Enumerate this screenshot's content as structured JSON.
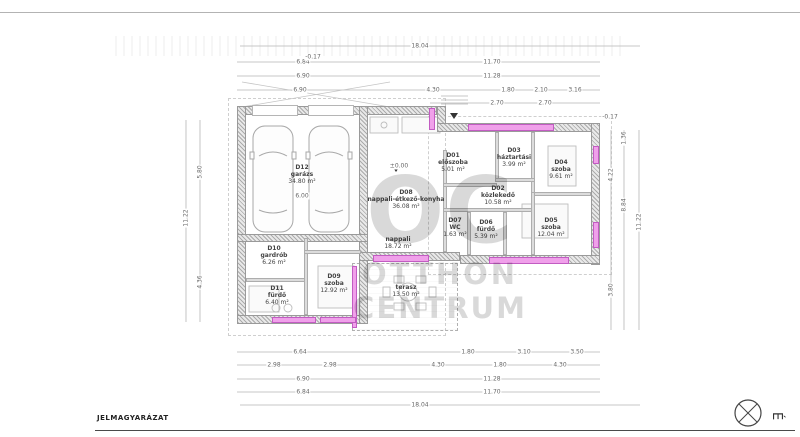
{
  "watermark": {
    "line1": "OC",
    "line2": "OTTHON",
    "line3": "CENTRUM"
  },
  "legend": {
    "label": "JELMAGYARÁZAT"
  },
  "compass": {
    "label": "É"
  },
  "colors": {
    "window_fill": "#f0a0ea",
    "window_border": "#c25cc2",
    "wall_line": "#9a9a9a",
    "drawing_line": "#b5b5b5",
    "text": "#444444",
    "watermark": "rgba(0,0,0,0.15)",
    "legend_text": "#222222"
  },
  "rooms": [
    {
      "id": "D12",
      "name": "garázs",
      "area": "34.80 m²",
      "x": 302,
      "y": 175
    },
    {
      "id": "D01",
      "name": "előszoba",
      "area": "5.01 m²",
      "x": 453,
      "y": 163
    },
    {
      "id": "D02",
      "name": "közlekedő",
      "area": "10.58 m²",
      "x": 498,
      "y": 196
    },
    {
      "id": "D03",
      "name": "háztartási",
      "area": "3.99 m²",
      "x": 514,
      "y": 158
    },
    {
      "id": "D04",
      "name": "szoba",
      "area": "9.61 m²",
      "x": 561,
      "y": 170
    },
    {
      "id": "D05",
      "name": "szoba",
      "area": "12.04 m²",
      "x": 551,
      "y": 228
    },
    {
      "id": "D06",
      "name": "fürdő",
      "area": "5.39 m²",
      "x": 486,
      "y": 230
    },
    {
      "id": "D07",
      "name": "WC",
      "area": "1.63 m²",
      "x": 455,
      "y": 228
    },
    {
      "id": "D08",
      "name": "nappali-étkező-konyha",
      "area": "36.08 m²",
      "x": 406,
      "y": 200
    },
    {
      "id": "",
      "name": "nappali",
      "area": "18.72 m²",
      "x": 398,
      "y": 243
    },
    {
      "id": "D09",
      "name": "szoba",
      "area": "12.92 m²",
      "x": 334,
      "y": 284
    },
    {
      "id": "D10",
      "name": "gardrób",
      "area": "6.26 m²",
      "x": 274,
      "y": 256
    },
    {
      "id": "D11",
      "name": "fürdő",
      "area": "6.40 m²",
      "x": 277,
      "y": 296
    },
    {
      "id": "",
      "name": "terasz",
      "area": "13.50 m²",
      "x": 406,
      "y": 291
    }
  ],
  "annotations": [
    {
      "text": "18.04",
      "x": 420,
      "y": 46
    },
    {
      "text": "6.84",
      "x": 303,
      "y": 62
    },
    {
      "text": "11.70",
      "x": 492,
      "y": 62
    },
    {
      "text": "6.90",
      "x": 303,
      "y": 76
    },
    {
      "text": "11.28",
      "x": 492,
      "y": 76
    },
    {
      "text": "6.90",
      "x": 300,
      "y": 90
    },
    {
      "text": "4.30",
      "x": 433,
      "y": 90
    },
    {
      "text": "1.80",
      "x": 508,
      "y": 90
    },
    {
      "text": "2.10",
      "x": 541,
      "y": 90
    },
    {
      "text": "3.16",
      "x": 575,
      "y": 90
    },
    {
      "text": "2.70",
      "x": 497,
      "y": 103
    },
    {
      "text": "2.70",
      "x": 545,
      "y": 103
    },
    {
      "text": "-0.17",
      "x": 313,
      "y": 57
    },
    {
      "text": "-0.17",
      "x": 610,
      "y": 117
    },
    {
      "text": "±0.00",
      "x": 399,
      "y": 166
    },
    {
      "text": "6.00",
      "x": 302,
      "y": 196
    },
    {
      "text": "6.64",
      "x": 300,
      "y": 352
    },
    {
      "text": "1.80",
      "x": 468,
      "y": 352
    },
    {
      "text": "3.10",
      "x": 524,
      "y": 352
    },
    {
      "text": "3.50",
      "x": 577,
      "y": 352
    },
    {
      "text": "2.98",
      "x": 274,
      "y": 365
    },
    {
      "text": "2.98",
      "x": 330,
      "y": 365
    },
    {
      "text": "4.30",
      "x": 438,
      "y": 365
    },
    {
      "text": "1.80",
      "x": 500,
      "y": 365
    },
    {
      "text": "4.30",
      "x": 560,
      "y": 365
    },
    {
      "text": "6.90",
      "x": 303,
      "y": 379
    },
    {
      "text": "11.28",
      "x": 492,
      "y": 379
    },
    {
      "text": "6.84",
      "x": 303,
      "y": 392
    },
    {
      "text": "11.70",
      "x": 492,
      "y": 392
    },
    {
      "text": "18.04",
      "x": 420,
      "y": 405
    },
    {
      "text": "11.22",
      "x": 186,
      "y": 218,
      "rot": true
    },
    {
      "text": "5.80",
      "x": 200,
      "y": 172,
      "rot": true
    },
    {
      "text": "4.36",
      "x": 200,
      "y": 282,
      "rot": true
    },
    {
      "text": "11.22",
      "x": 639,
      "y": 222,
      "rot": true
    },
    {
      "text": "8.84",
      "x": 624,
      "y": 205,
      "rot": true
    },
    {
      "text": "1.36",
      "x": 624,
      "y": 138,
      "rot": true
    },
    {
      "text": "4.22",
      "x": 611,
      "y": 175,
      "rot": true
    },
    {
      "text": "3.80",
      "x": 611,
      "y": 290,
      "rot": true
    }
  ],
  "walls": [
    {
      "x": 237,
      "y": 106,
      "w": 200,
      "h": 9
    },
    {
      "x": 437,
      "y": 106,
      "w": 9,
      "h": 26
    },
    {
      "x": 437,
      "y": 123,
      "w": 163,
      "h": 9
    },
    {
      "x": 237,
      "y": 106,
      "w": 9,
      "h": 218
    },
    {
      "x": 591,
      "y": 123,
      "w": 9,
      "h": 142
    },
    {
      "x": 237,
      "y": 315,
      "w": 131,
      "h": 9
    },
    {
      "x": 359,
      "y": 106,
      "w": 9,
      "h": 218
    },
    {
      "x": 237,
      "y": 234,
      "w": 131,
      "h": 8
    },
    {
      "x": 359,
      "y": 252,
      "w": 101,
      "h": 9
    },
    {
      "x": 460,
      "y": 255,
      "w": 140,
      "h": 9
    }
  ],
  "interior_walls": [
    {
      "x": 443,
      "y": 150,
      "w": 4,
      "h": 102
    },
    {
      "x": 443,
      "y": 183,
      "w": 54,
      "h": 4
    },
    {
      "x": 495,
      "y": 132,
      "w": 4,
      "h": 50
    },
    {
      "x": 531,
      "y": 132,
      "w": 4,
      "h": 64
    },
    {
      "x": 495,
      "y": 178,
      "w": 40,
      "h": 4
    },
    {
      "x": 531,
      "y": 192,
      "w": 60,
      "h": 4
    },
    {
      "x": 443,
      "y": 208,
      "w": 92,
      "h": 4
    },
    {
      "x": 467,
      "y": 212,
      "w": 4,
      "h": 43
    },
    {
      "x": 503,
      "y": 212,
      "w": 4,
      "h": 43
    },
    {
      "x": 531,
      "y": 192,
      "w": 4,
      "h": 63
    },
    {
      "x": 246,
      "y": 278,
      "w": 62,
      "h": 4
    },
    {
      "x": 304,
      "y": 238,
      "w": 4,
      "h": 77
    },
    {
      "x": 304,
      "y": 250,
      "w": 57,
      "h": 4
    }
  ],
  "windows": [
    {
      "x": 468,
      "y": 124,
      "w": 86,
      "h": 7
    },
    {
      "x": 429,
      "y": 108,
      "w": 6,
      "h": 22
    },
    {
      "x": 593,
      "y": 146,
      "w": 6,
      "h": 18
    },
    {
      "x": 593,
      "y": 222,
      "w": 6,
      "h": 26
    },
    {
      "x": 489,
      "y": 257,
      "w": 80,
      "h": 7
    },
    {
      "x": 373,
      "y": 255,
      "w": 56,
      "h": 7
    },
    {
      "x": 352,
      "y": 266,
      "w": 5,
      "h": 62
    },
    {
      "x": 272,
      "y": 317,
      "w": 44,
      "h": 6
    },
    {
      "x": 320,
      "y": 317,
      "w": 36,
      "h": 6
    }
  ],
  "openings": [
    {
      "x": 252,
      "y": 105,
      "w": 46,
      "h": 11
    },
    {
      "x": 308,
      "y": 105,
      "w": 46,
      "h": 11
    }
  ]
}
